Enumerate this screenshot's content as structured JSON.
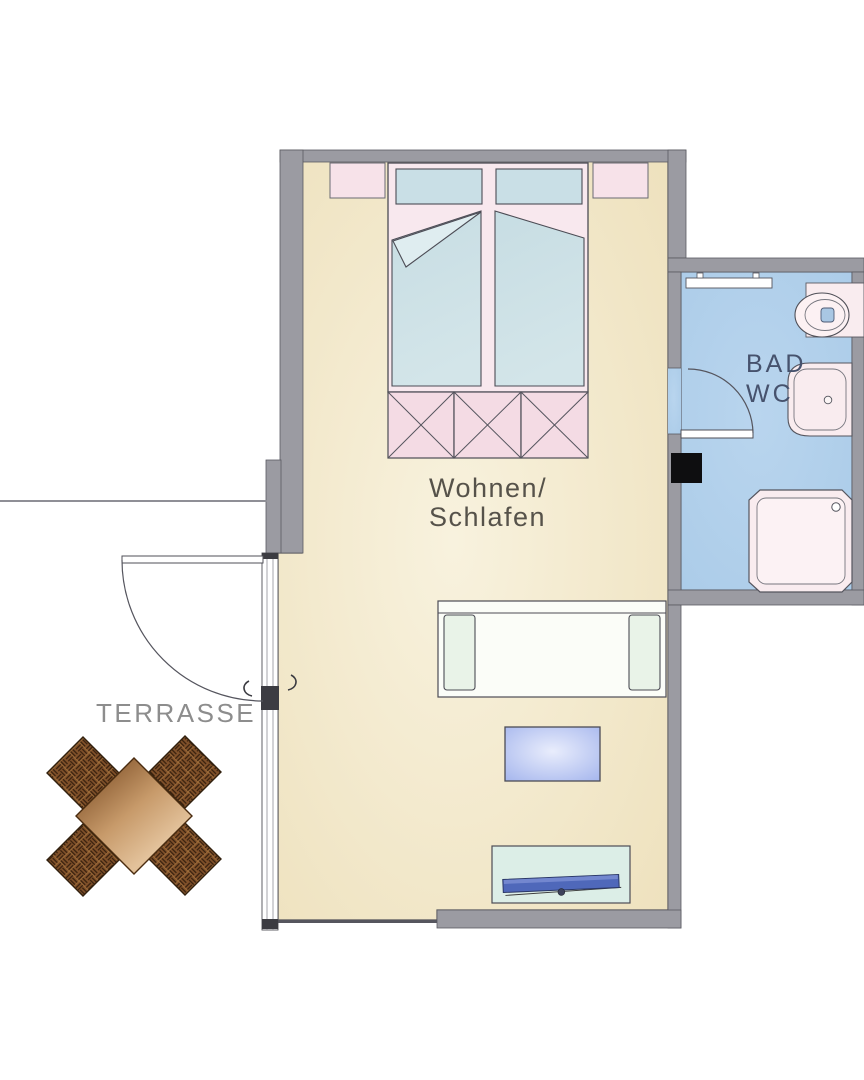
{
  "rooms": {
    "living": {
      "label_lines": [
        "Wohnen/",
        "Schlafen"
      ]
    },
    "bath": {
      "label_lines": [
        "BAD",
        "WC"
      ]
    },
    "terrace": {
      "label": "TERRASSE"
    }
  },
  "colors": {
    "wall": "#9b9ba2",
    "wall_line": "#4f4f57",
    "floor_living_center": "#f8f2de",
    "floor_living_edge": "#eee1bd",
    "floor_bath": "#aacbe8",
    "bed_frame_pink": "#f8e8ee",
    "nightstand_pink": "#f7e2e9",
    "bench_pink": "#f4dbe4",
    "mattress_blue": "#d3e5e9",
    "pillow_blue": "#c9dfe6",
    "sofa_white": "#fbfdf8",
    "sofa_armrest": "#e9f3e8",
    "coffee_table_center": "#e9edfc",
    "coffee_table_edge": "#a9b9ee",
    "sideboard": "#dceee7",
    "tv_blue": "#4f68ba",
    "fixture_pink": "#f9ecef",
    "toilet_flush_blue": "#a9c7e3",
    "wood_dark": "#6e3f18",
    "wood_mid": "#c79a6a",
    "wood_light": "#e3c29b",
    "wood_end": "#cfa473",
    "wicker_base": "#81512a",
    "wicker_dark": "#38200e",
    "label_living": "#56524a",
    "label_bath": "#46526d",
    "label_terrace": "#8d8d8d"
  }
}
